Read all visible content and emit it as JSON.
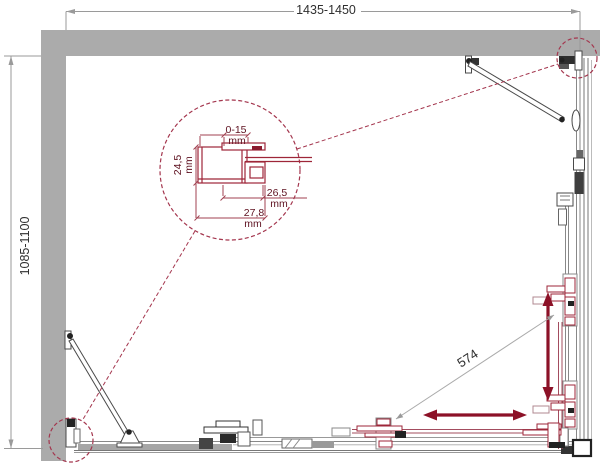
{
  "drawing": {
    "title": "shower-enclosure-plan-drawing",
    "dims": {
      "width": "1435-1450",
      "depth": "1085-1100",
      "opening": "574"
    },
    "detail": {
      "adjustment_value": "0-15",
      "adjustment_unit": "mm",
      "depth_value": "24,5",
      "depth_unit": "mm",
      "clamp_value": "26,5",
      "clamp_unit": "mm",
      "profile_value": "27,8",
      "profile_unit": "mm"
    },
    "colors": {
      "wall_gray": "#ababab",
      "frame_gray": "#4a4a4a",
      "dimension_gray": "#9a9a9a",
      "accent_red": "#9e2638",
      "door_red": "#a34c5e",
      "arrow_red": "#8c1127",
      "leader_red": "#a4364e",
      "label_text": "#2f2f2f",
      "detail_text": "#5e1120"
    }
  }
}
